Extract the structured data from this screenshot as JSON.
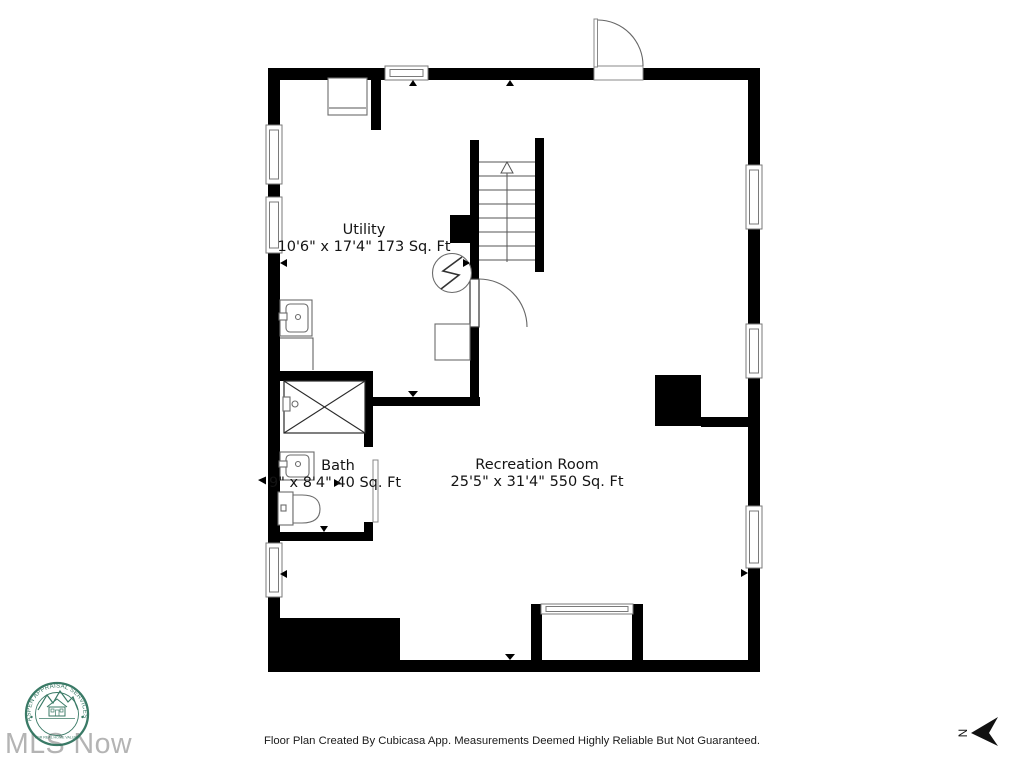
{
  "rooms": {
    "utility": {
      "name": "Utility",
      "dims": "10'6\" x 17'4\" 173 Sq. Ft"
    },
    "bath": {
      "name": "Bath",
      "dims": "9\" x 8'4\" 40 Sq. Ft"
    },
    "recreation": {
      "name": "Recreation Room",
      "dims": "25'5\" x 31'4\" 550 Sq. Ft"
    }
  },
  "footer": {
    "disclaimer": "Floor Plan Created By Cubicasa App. Measurements Deemed Highly Reliable But Not Guaranteed."
  },
  "watermark": {
    "text": "MLS Now",
    "color": "#b4b4b4"
  },
  "stamp": {
    "ring_top": "ASPEN APPRAISAL SERVICES",
    "ring_bottom": "FOR REAL HOME VALUES",
    "color": "#2a6f5a"
  },
  "compass": {
    "letter": "N"
  },
  "colors": {
    "wall": "#000000",
    "background": "#ffffff",
    "fixture_outline": "#6b6b6b"
  }
}
